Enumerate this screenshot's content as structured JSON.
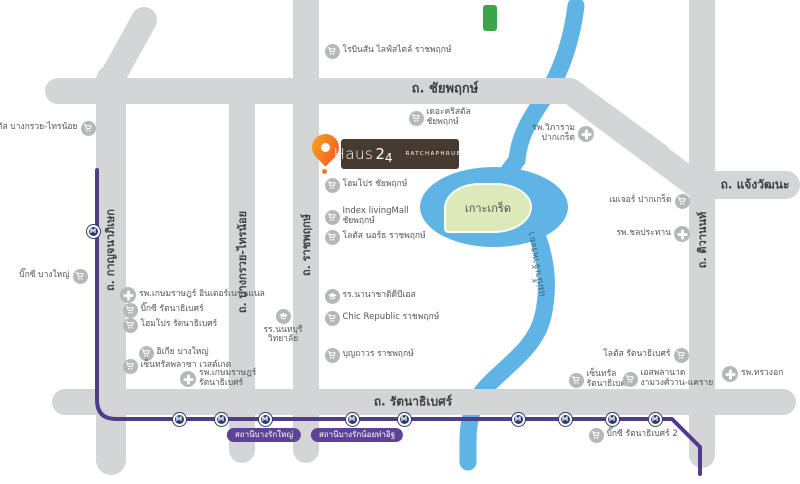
{
  "colors": {
    "road": "#d3d5d7",
    "river": "#5fb3e5",
    "island": "#dde9b8",
    "mrt_purple": "#523a8c",
    "pill": "#5c4397",
    "brand_brown": "#473a30",
    "poi_gray": "#b5b8ba",
    "green_tag": "#3aa648"
  },
  "brand": {
    "name": "Haus",
    "number_big": "2",
    "number_small": "4",
    "subtitle": "RATCHAPHRUEK"
  },
  "island": {
    "label": "เกาะเกร็ด"
  },
  "river": {
    "label": "แม่น้ำเจ้าพระยา"
  },
  "mrt": {
    "m_label": "M",
    "stations": [
      {
        "x": 93,
        "y": 231
      },
      {
        "x": 179,
        "y": 419
      },
      {
        "x": 221,
        "y": 419
      },
      {
        "x": 265,
        "y": 419
      },
      {
        "x": 352,
        "y": 419
      },
      {
        "x": 404,
        "y": 419
      },
      {
        "x": 518,
        "y": 419
      },
      {
        "x": 565,
        "y": 419
      },
      {
        "x": 612,
        "y": 419
      },
      {
        "x": 655,
        "y": 419
      }
    ],
    "station_labels": [
      {
        "text": "สถานีบางรักใหญ่",
        "x": 264,
        "y": 428
      },
      {
        "text": "สถานีบางรักน้อยท่าอิฐ",
        "x": 357,
        "y": 428
      }
    ]
  },
  "road_labels": [
    {
      "id": "chaiyaphruek",
      "text": "ถ. ชัยพฤกษ์",
      "x": 445,
      "y": 88,
      "orient": "h",
      "size": 13
    },
    {
      "id": "chaengwattana",
      "text": "ถ. แจ้งวัฒนะ",
      "x": 755,
      "y": 185,
      "orient": "h",
      "size": 12
    },
    {
      "id": "rattanathibet",
      "text": "ถ. รัตนาธิเบศร์",
      "x": 413,
      "y": 402,
      "orient": "h",
      "size": 12
    },
    {
      "id": "ratchaphruek",
      "text": "ถ. ราชพฤกษ์",
      "x": 306,
      "y": 245,
      "orient": "v",
      "size": 11
    },
    {
      "id": "bangkruai-sainoi",
      "text": "ถ. บางกรวย-ไทรน้อย",
      "x": 242,
      "y": 262,
      "orient": "v",
      "size": 11
    },
    {
      "id": "kanchanaphisek",
      "text": "ถ. กาญจนาภิเษก",
      "x": 110,
      "y": 250,
      "orient": "v",
      "size": 11
    },
    {
      "id": "tiwanon",
      "text": "ถ. ติวานนท์",
      "x": 702,
      "y": 240,
      "orient": "v",
      "size": 11
    }
  ],
  "pois": [
    {
      "lines": [
        "โลตัส บางกรวย-ไทรน้อย"
      ],
      "icon": "cart",
      "side": "right",
      "x": 88,
      "y": 128
    },
    {
      "lines": [
        "บิ๊กซี บางใหญ่"
      ],
      "icon": "cart",
      "side": "right",
      "x": 80,
      "y": 276
    },
    {
      "lines": [
        "รพ.เกษมราษฎร์ อินเตอร์เนชั่นแนล"
      ],
      "icon": "cross",
      "side": "left",
      "x": 128,
      "y": 295
    },
    {
      "lines": [
        "บิ๊กซี รัตนาธิเบศร์"
      ],
      "icon": "cart",
      "side": "left",
      "x": 130,
      "y": 310
    },
    {
      "lines": [
        "โฮมโปร รัตนาธิเบศร์"
      ],
      "icon": "cart",
      "side": "left",
      "x": 130,
      "y": 325
    },
    {
      "lines": [
        "อิเกีย บางใหญ่"
      ],
      "icon": "cart",
      "side": "left",
      "x": 146,
      "y": 353
    },
    {
      "lines": [
        "เซ็นทรัลพลาซา เวสต์เกต"
      ],
      "icon": "cart",
      "side": "left",
      "x": 130,
      "y": 366
    },
    {
      "lines": [
        "รพ.เกษมราษฎร์",
        "รัตนาธิเบศร์"
      ],
      "icon": "cross",
      "side": "left",
      "x": 188,
      "y": 379
    },
    {
      "lines": [
        "โรบินสัน ไลฟ์สไตล์ ราชพฤกษ์"
      ],
      "icon": "cart",
      "side": "left",
      "x": 332,
      "y": 51
    },
    {
      "lines": [
        "เดอะคริสตัล",
        "ชัยพฤกษ์"
      ],
      "icon": "cart",
      "side": "left",
      "x": 416,
      "y": 118
    },
    {
      "lines": [
        "โฮมโปร ชัยพฤกษ์"
      ],
      "icon": "cart",
      "side": "left",
      "x": 332,
      "y": 185
    },
    {
      "lines": [
        "Index livingMall",
        "ชัยพฤกษ์"
      ],
      "icon": "cart",
      "side": "left",
      "x": 332,
      "y": 217
    },
    {
      "lines": [
        "โลตัส นอร์ธ ราชพฤกษ์"
      ],
      "icon": "cart",
      "side": "left",
      "x": 332,
      "y": 237
    },
    {
      "lines": [
        "รร.นนทบุรี",
        "วิทยาลัย"
      ],
      "icon": "school",
      "side": "below",
      "x": 283,
      "y": 316
    },
    {
      "lines": [
        "รร.นานาชาติดีบีเอส"
      ],
      "icon": "school",
      "side": "left",
      "x": 332,
      "y": 296
    },
    {
      "lines": [
        "Chic Republic ราชพฤกษ์"
      ],
      "icon": "cart",
      "side": "left",
      "x": 332,
      "y": 318
    },
    {
      "lines": [
        "บุญถาวร ราชพฤกษ์"
      ],
      "icon": "cart",
      "side": "left",
      "x": 332,
      "y": 355
    },
    {
      "lines": [
        "รพ.วิภาราม",
        "ปากเกร็ด"
      ],
      "icon": "cross",
      "side": "right",
      "x": 586,
      "y": 134
    },
    {
      "lines": [
        "เมเจอร์ ปากเกร็ด"
      ],
      "icon": "cart",
      "side": "right",
      "x": 682,
      "y": 201
    },
    {
      "lines": [
        "รพ.ชลประทาน"
      ],
      "icon": "cross",
      "side": "right",
      "x": 682,
      "y": 234
    },
    {
      "lines": [
        "รพ.ทรวงอก"
      ],
      "icon": "cross",
      "side": "left",
      "x": 730,
      "y": 374
    },
    {
      "lines": [
        "โลตัส รัตนาธิเบศร์"
      ],
      "icon": "cart",
      "side": "right",
      "x": 681,
      "y": 355
    },
    {
      "lines": [
        "เซ็นทรัล",
        "รัตนาธิเบศร์"
      ],
      "icon": "cart",
      "side": "left",
      "x": 576,
      "y": 380
    },
    {
      "lines": [
        "เอสพลานาด",
        "งามวงศ์วาน-แคราย"
      ],
      "icon": "cart",
      "side": "left",
      "x": 630,
      "y": 379
    },
    {
      "lines": [
        "บิ๊กซี รัตนาธิเบศร์ 2"
      ],
      "icon": "cart",
      "side": "left",
      "x": 596,
      "y": 435
    }
  ]
}
